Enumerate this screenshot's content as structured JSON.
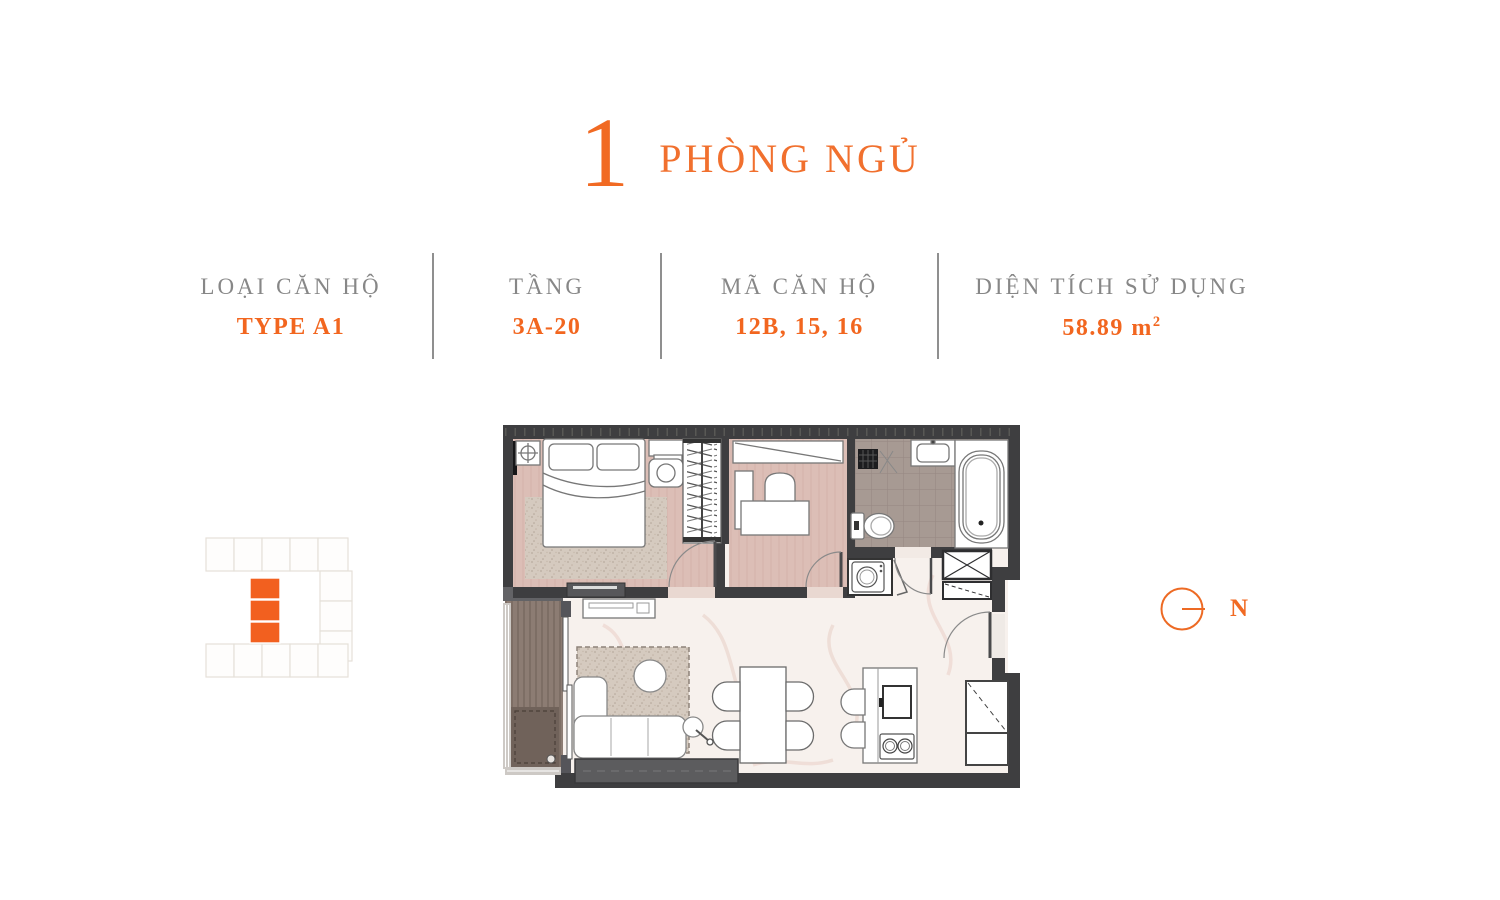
{
  "header": {
    "number": "1",
    "title": "PHÒNG NGỦ"
  },
  "info": {
    "items": [
      {
        "label": "LOẠI CĂN HỘ",
        "value": "TYPE A1"
      },
      {
        "label": "TẦNG",
        "value": "3A-20"
      },
      {
        "label": "MÃ CĂN HỘ",
        "value": "12B, 15, 16"
      },
      {
        "label": "DIỆN TÍCH SỬ DỤNG",
        "value": "58.89 m",
        "value_sup": "2"
      }
    ]
  },
  "compass": {
    "label": "N"
  },
  "locator": {
    "highlighted_units": 3
  },
  "colors": {
    "accent": "#F16A23",
    "label_gray": "#878787",
    "divider_gray": "#8F8F8F",
    "wall_dark": "#3E3E40",
    "floor_pink": "#DCBEB6",
    "floor_bath_gray": "#A79A93",
    "floor_marble": "#F7F1ED",
    "balcony_wood": "#8C7C73"
  }
}
